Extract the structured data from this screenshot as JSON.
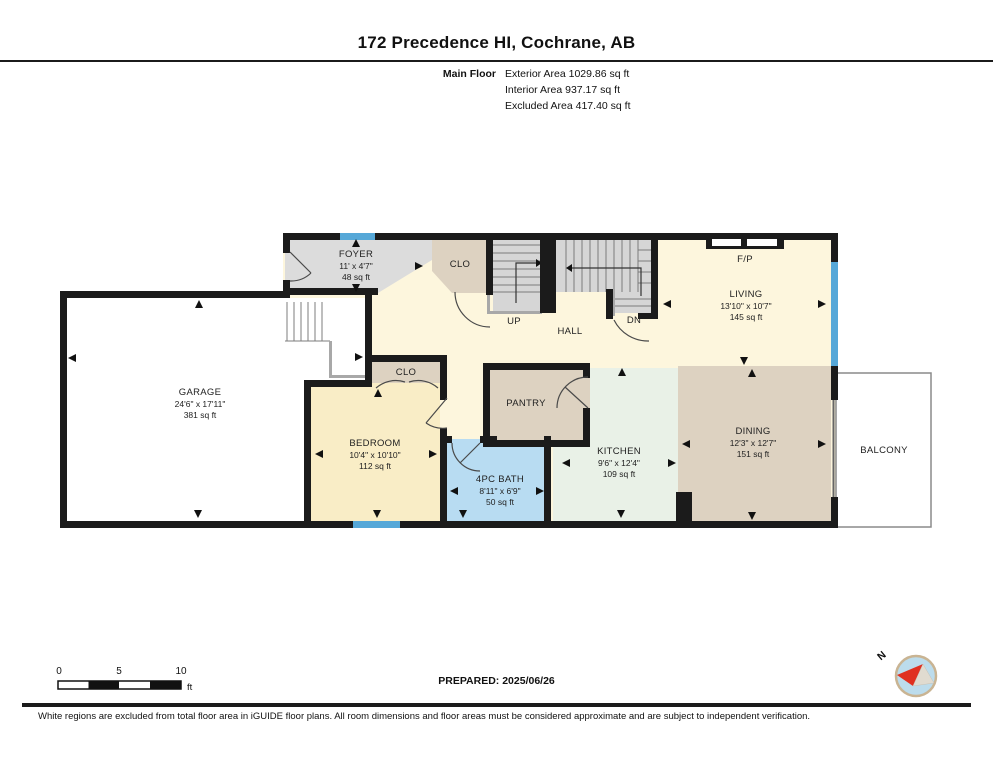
{
  "header": {
    "title": "172 Precedence HI, Cochrane, AB",
    "floor_label": "Main Floor",
    "area_lines": {
      "exterior": "Exterior Area 1029.86 sq ft",
      "interior": "Interior Area 937.17 sq ft",
      "excluded": "Excluded Area 417.40 sq ft"
    }
  },
  "rooms": {
    "foyer": {
      "name": "FOYER",
      "dims": "11' x 4'7\"",
      "area": "48 sq ft"
    },
    "foyer_closet": {
      "name": "CLO"
    },
    "up": {
      "name": "UP"
    },
    "down": {
      "name": "DN"
    },
    "hall": {
      "name": "HALL"
    },
    "fireplace": {
      "name": "F/P"
    },
    "living": {
      "name": "LIVING",
      "dims": "13'10\" x 10'7\"",
      "area": "145 sq ft"
    },
    "garage": {
      "name": "GARAGE",
      "dims": "24'6\" x 17'11\"",
      "area": "381 sq ft"
    },
    "bedroom_closet": {
      "name": "CLO"
    },
    "bedroom": {
      "name": "BEDROOM",
      "dims": "10'4\" x 10'10\"",
      "area": "112 sq ft"
    },
    "pantry": {
      "name": "PANTRY"
    },
    "bath": {
      "name": "4PC BATH",
      "dims": "8'11\" x 6'9\"",
      "area": "50 sq ft"
    },
    "kitchen": {
      "name": "KITCHEN",
      "dims": "9'6\" x 12'4\"",
      "area": "109 sq ft"
    },
    "dining": {
      "name": "DINING",
      "dims": "12'3\" x 12'7\"",
      "area": "151 sq ft"
    },
    "balcony": {
      "name": "BALCONY"
    }
  },
  "scale_bar": {
    "tick_0": "0",
    "tick_5": "5",
    "tick_10": "10",
    "unit": "ft"
  },
  "prepared_label": "PREPARED: 2025/06/26",
  "compass": {
    "north_label": "N"
  },
  "footer_note": "White regions are excluded from total floor area in iGUIDE floor plans. All room dimensions and floor areas must be considered approximate and are subject to independent verification.",
  "colors": {
    "wall": "#1b1b1b",
    "interior_cream": "#fdf6dd",
    "bedroom_cream": "#f9edc6",
    "room_gray": "#dcdcdc",
    "closet_tan": "#ddd2c1",
    "bath_blue": "#b8dcf2",
    "kitchen_mint": "#e9f1e7",
    "window_blue": "#56a8d8",
    "compass_red": "#e03020"
  }
}
